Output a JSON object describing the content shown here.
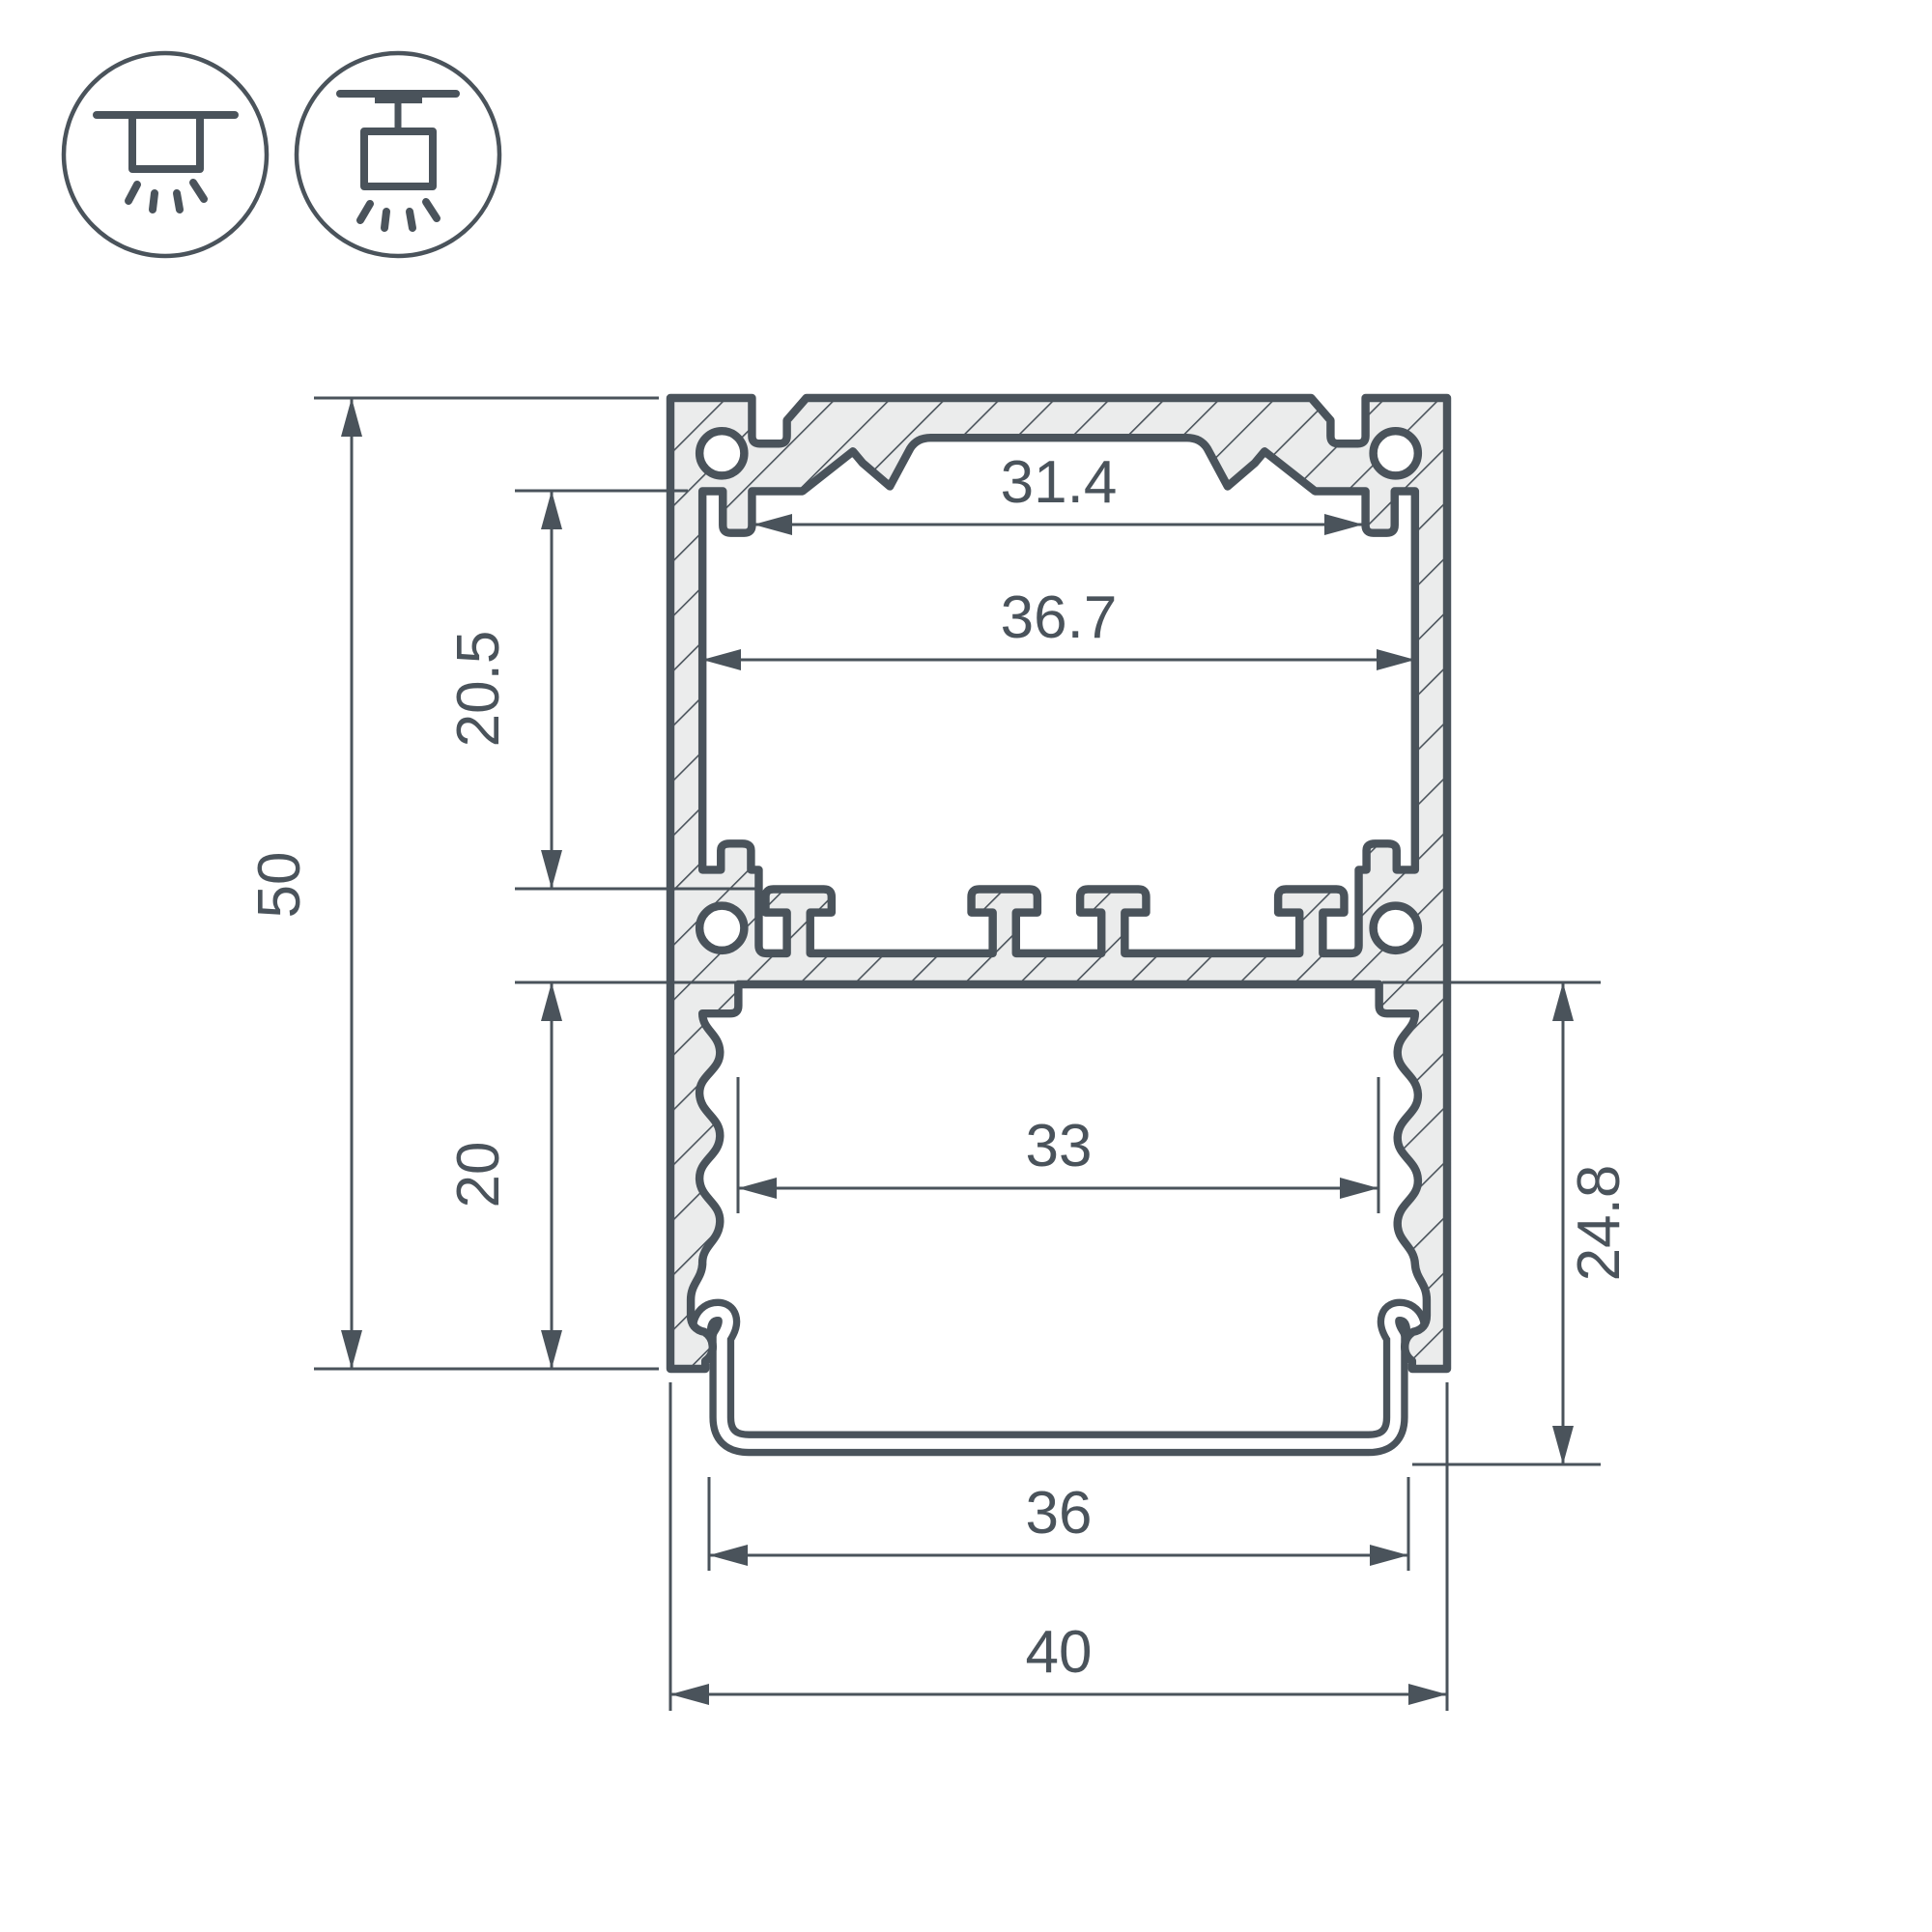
{
  "colors": {
    "line": "#4a535b",
    "metal_fill": "#ebecec",
    "white": "#ffffff"
  },
  "icons": {
    "surface_mount": {
      "name": "surface-ceiling-mount-icon"
    },
    "pendant_mount": {
      "name": "pendant-ceiling-mount-icon"
    }
  },
  "drawing": {
    "type": "technical-cross-section",
    "dims": {
      "overall_height": "50",
      "upper_section_height": "20.5",
      "lower_section_height": "20",
      "top_slot_width": "31.4",
      "upper_inner_width": "36.7",
      "lower_inner_width": "33",
      "diffuser_depth": "24.8",
      "diffuser_width": "36",
      "overall_width": "40"
    }
  }
}
